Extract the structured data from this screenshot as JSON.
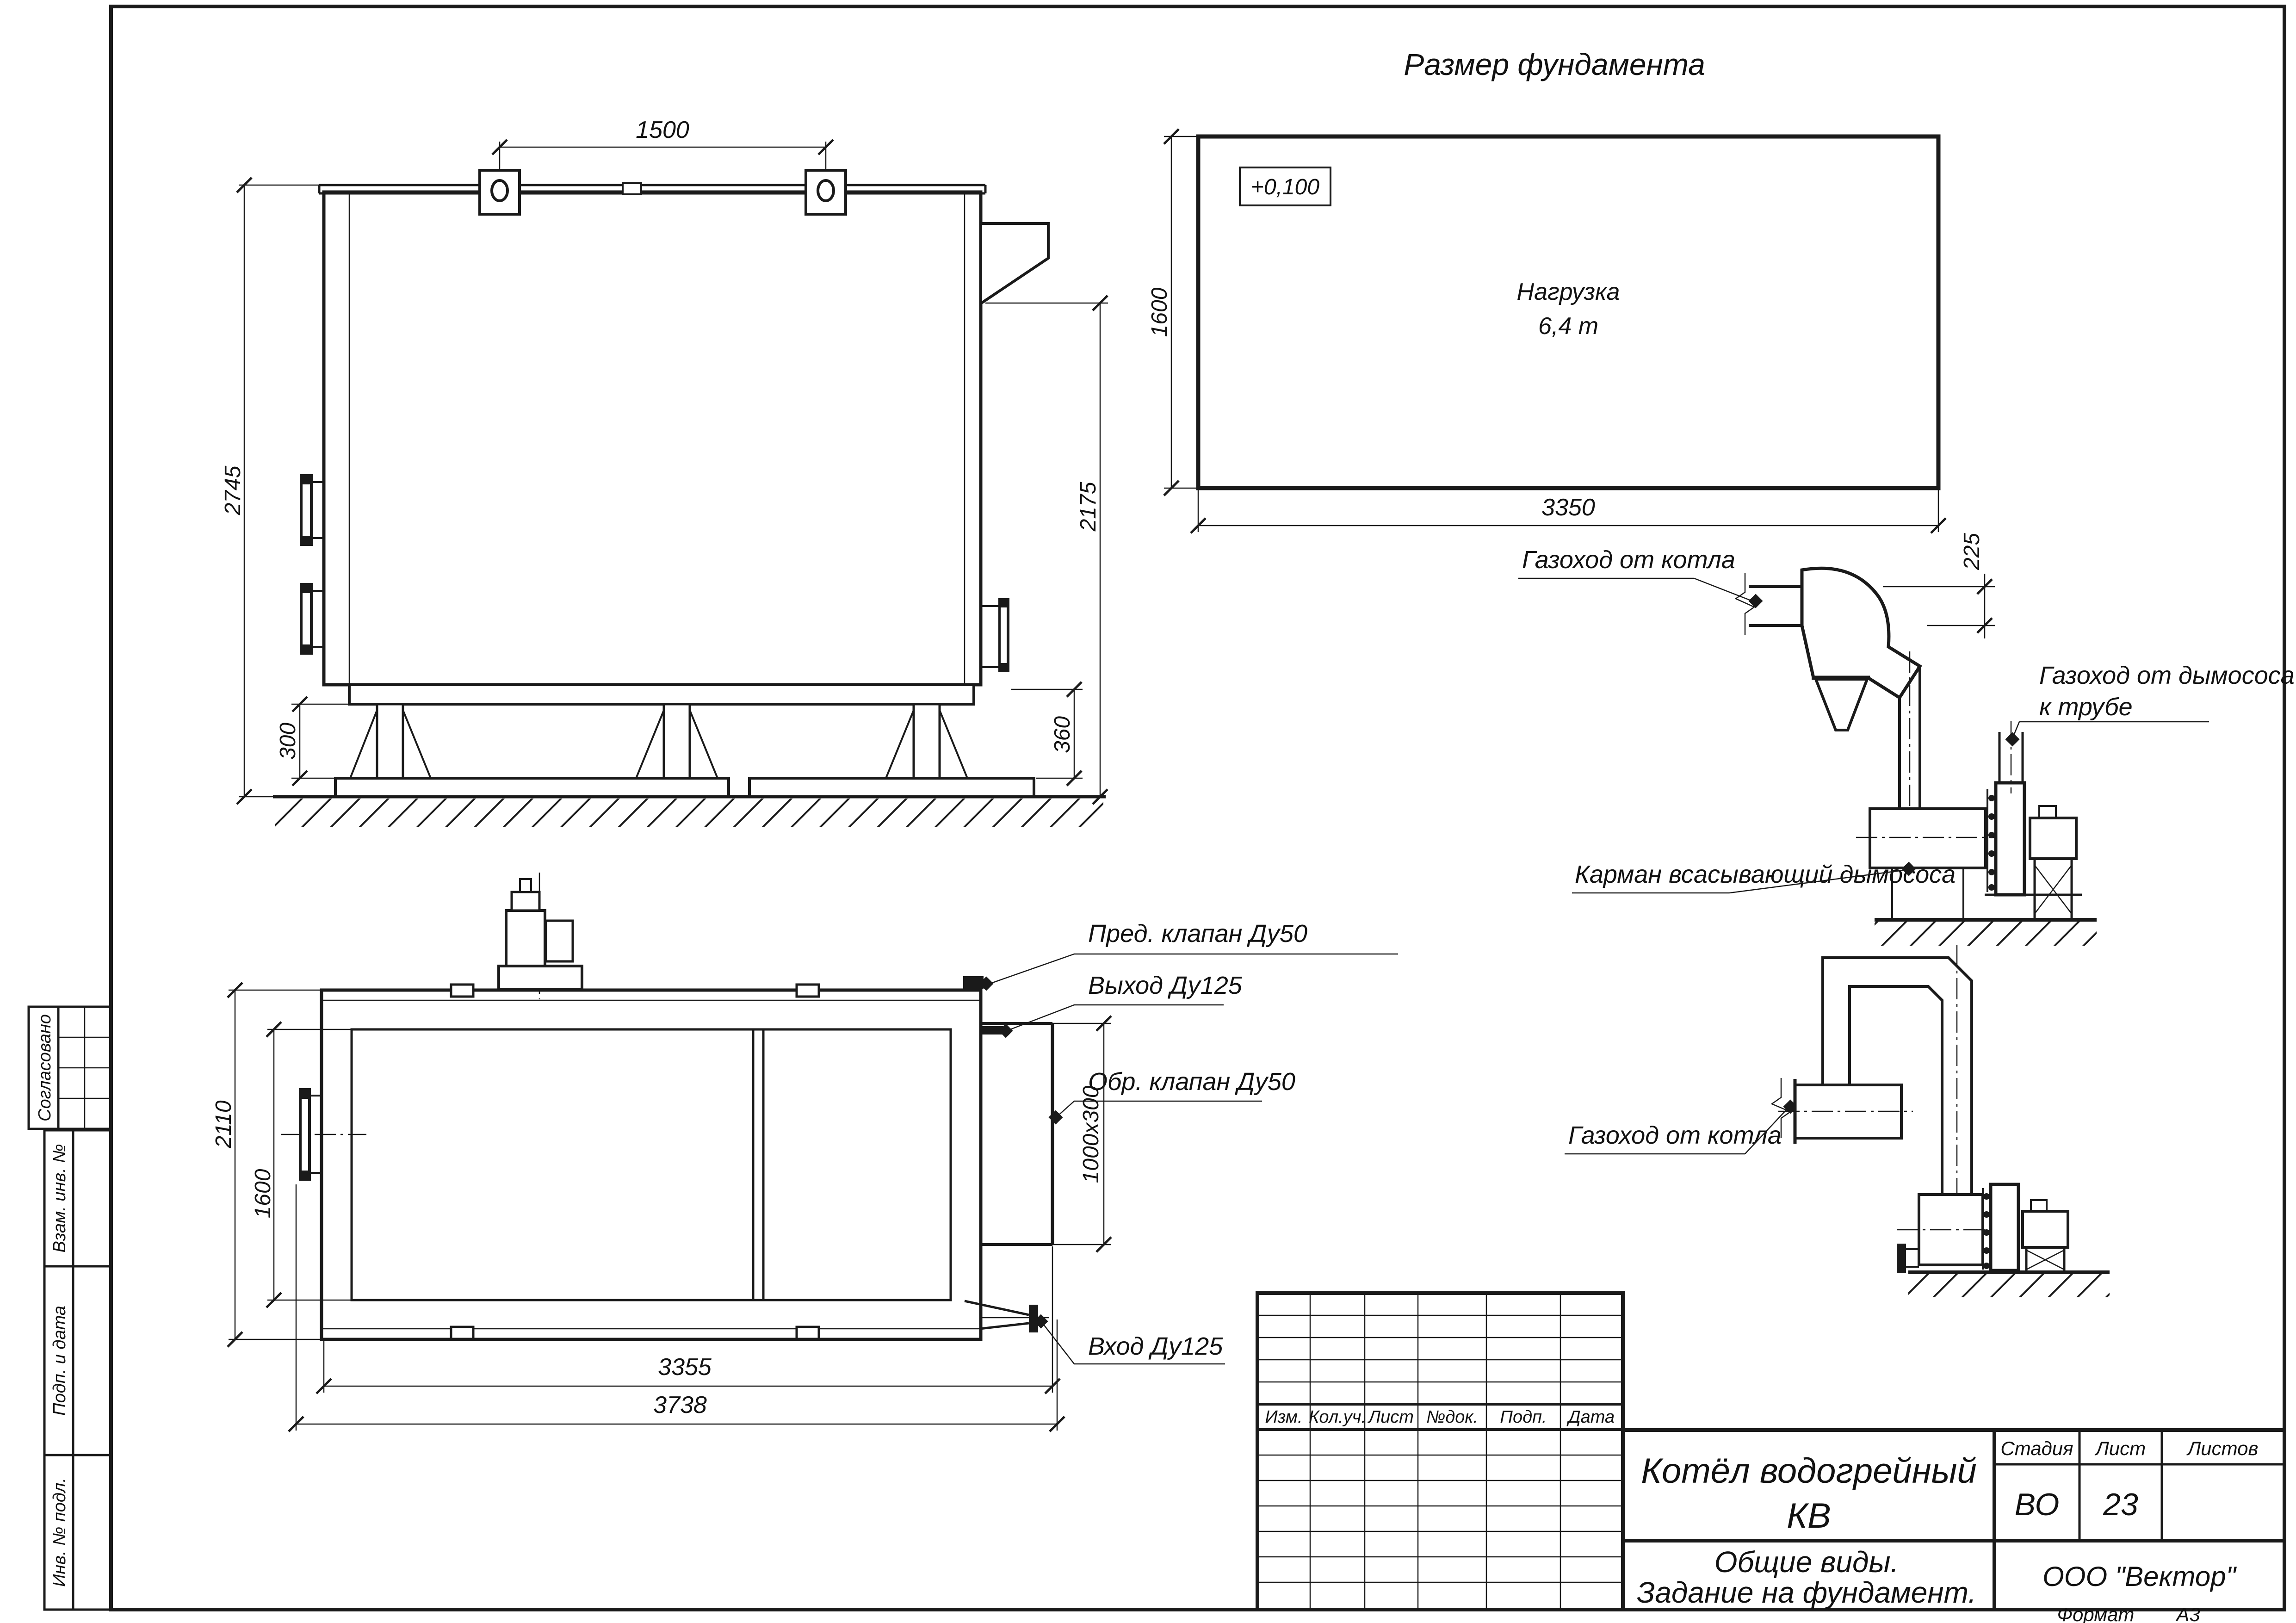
{
  "drawing": {
    "title": "Размер фундамента",
    "format_label": "Формат",
    "format_value": "А3"
  },
  "side_stamp": {
    "approved": "Согласовано",
    "replace_inv": "Взам. инв. №",
    "sign_date": "Подп. и дата",
    "inv_orig": "Инв. № подл."
  },
  "side_view": {
    "dim_lugs": "1500",
    "dim_height": "2745",
    "dim_outlet_height": "2175",
    "dim_base_height": "300",
    "dim_nozzle_height": "360"
  },
  "foundation_plan": {
    "elevation_mark": "+0,100",
    "load_label_1": "Нагрузка",
    "load_label_2": "6,4 т",
    "dim_length": "3350",
    "dim_width": "1600",
    "dim_offset": "225"
  },
  "flue_upper": {
    "label_from_boiler": "Газоход от котла",
    "label_to_stack_1": "Газоход от дымососа",
    "label_to_stack_2": "к трубе",
    "label_pocket": "Карман всасывающий дымососа"
  },
  "flue_lower": {
    "label_from_boiler": "Газоход от котла"
  },
  "plan_view": {
    "label_safety_valve": "Пред. клапан Ду50",
    "label_outlet": "Выход Ду125",
    "label_check_valve": "Обр. клапан Ду50",
    "label_inlet": "Вход Ду125",
    "dim_width": "2110",
    "dim_inner_width": "1600",
    "dim_length": "3355",
    "dim_total_length": "3738",
    "dim_duct": "1000х300"
  },
  "title_block": {
    "rev_headers": [
      "Изм.",
      "Кол.уч.",
      "Лист",
      "№док.",
      "Подп.",
      "Дата"
    ],
    "product_1": "Котёл водогрейный",
    "product_2": "КВ",
    "stage_label": "Стадия",
    "stage_value": "ВО",
    "sheet_label": "Лист",
    "sheet_value": "23",
    "sheets_label": "Листов",
    "doc_type_1": "Общие виды.",
    "doc_type_2": "Задание на фундамент.",
    "company": "ООО \"Вектор\""
  }
}
